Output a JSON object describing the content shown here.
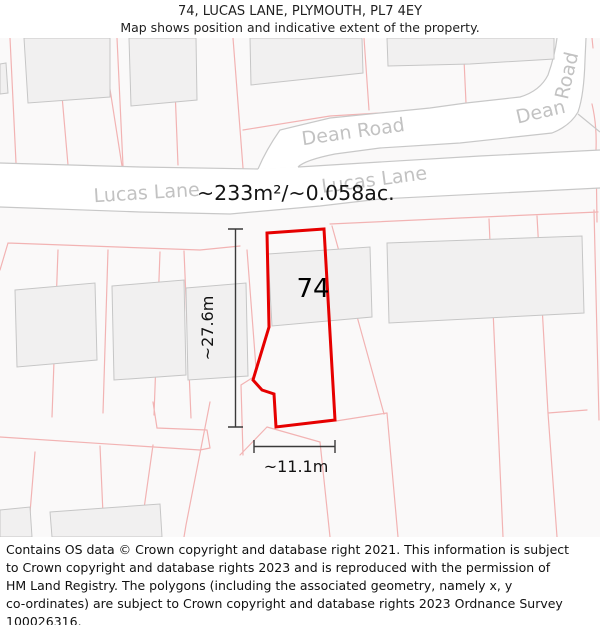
{
  "header": {
    "title": "74, LUCAS LANE, PLYMOUTH, PL7 4EY",
    "subtitle": "Map shows position and indicative extent of the property."
  },
  "map": {
    "property_number": "74",
    "area_label": "~233m²/~0.058ac.",
    "dim_vertical_label": "~27.6m",
    "dim_horizontal_label": "~11.1m",
    "road_labels": {
      "lucas_lane_left": "Lucas Lane",
      "lucas_lane_right": "Lucas Lane",
      "dean_road_left": "Dean Road",
      "dean_right_word1": "Dean",
      "dean_right_word2": "Road"
    },
    "colors": {
      "property_outline": "#e60000",
      "parcel_line": "#f2b3b3",
      "road_edge": "#c8c8c8",
      "road_fill": "#ffffff",
      "building_fill": "#f1f0f0",
      "building_stroke": "#c6c6c6",
      "road_label_gray": "#c2c2c2",
      "map_background": "#faf9f9",
      "dimension_line": "#3a3a3a"
    }
  },
  "footer": {
    "lines": [
      "Contains OS data © Crown copyright and database right 2021. This information is subject",
      "to Crown copyright and database rights 2023 and is reproduced with the permission of",
      "HM Land Registry. The polygons (including the associated geometry, namely x, y",
      "co-ordinates) are subject to Crown copyright and database rights 2023 Ordnance Survey",
      "100026316."
    ]
  }
}
